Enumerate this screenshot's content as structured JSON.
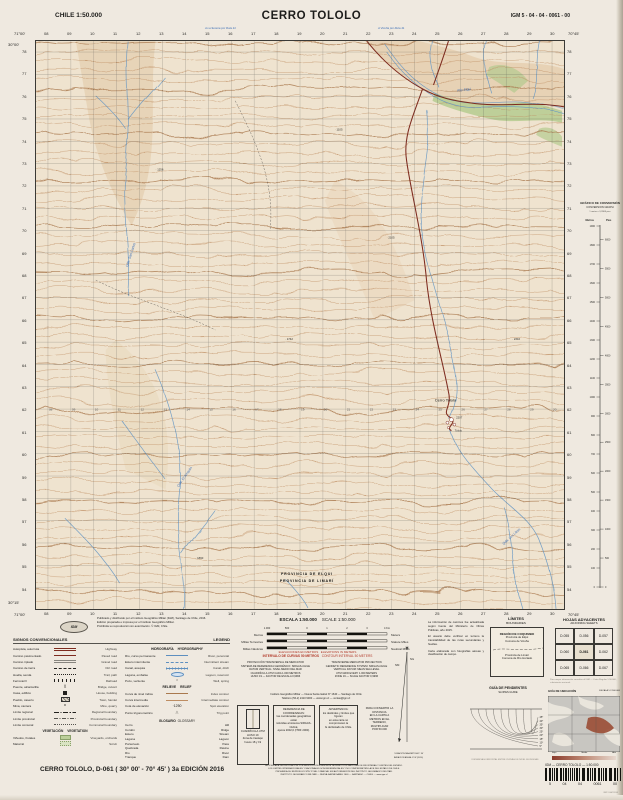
{
  "header": {
    "country_scale": "CHILE  1:50.000",
    "title": "CERRO TOLOLO",
    "sheet_code": "IGM 5 - 04 - 04 - 0061 - 00",
    "route_note_left": "A La Serena por Ruta 41",
    "route_note_right": "A Vicuña por Ruta 41"
  },
  "map": {
    "corners": {
      "tl_lon": "71°00'",
      "tr_lon": "70°45'",
      "bl_lon": "71°00'",
      "br_lon": "70°45'",
      "lat_top": "30°00'",
      "lat_bottom": "30°15'"
    },
    "top_labels": [
      "08",
      "09",
      "10",
      "11",
      "12",
      "13",
      "14",
      "15",
      "16",
      "17",
      "18",
      "19",
      "20",
      "21",
      "22",
      "23",
      "24",
      "25",
      "26",
      "27",
      "28",
      "29",
      "30"
    ],
    "left_labels": [
      "78",
      "77",
      "76",
      "75",
      "74",
      "73",
      "72",
      "71",
      "70",
      "69",
      "68",
      "67",
      "66",
      "65",
      "64",
      "63",
      "62",
      "61",
      "60",
      "59",
      "58",
      "57",
      "56",
      "55",
      "54"
    ],
    "place_labels": [
      {
        "t": "Cerro Tololo",
        "x": 411,
        "y": 362,
        "c": "place"
      },
      {
        "t": "Tololo",
        "x": 424,
        "y": 392,
        "c": "small"
      },
      {
        "t": "PROVINCIA DE ELQUI",
        "x": 272,
        "y": 536,
        "c": "prov"
      },
      {
        "t": "PROVINCIA DE LIMARÍ",
        "x": 272,
        "y": 543,
        "c": "prov"
      },
      {
        "t": "Río Elqui",
        "x": 430,
        "y": 50,
        "c": "water",
        "r": -6
      },
      {
        "t": "Qda. San Carlos",
        "x": 96,
        "y": 215,
        "c": "water",
        "r": -72
      },
      {
        "t": "Qda. El Arrayán",
        "x": 150,
        "y": 438,
        "c": "water",
        "r": -55
      },
      {
        "t": "Qda. Los Litres",
        "x": 478,
        "y": 498,
        "c": "water",
        "r": -42
      }
    ],
    "spot_heights": [
      {
        "v": "2207",
        "x": 420,
        "y": 379
      },
      {
        "v": "1256",
        "x": 120,
        "y": 130
      },
      {
        "v": "1742",
        "x": 250,
        "y": 300
      },
      {
        "v": "2105",
        "x": 352,
        "y": 198
      },
      {
        "v": "1890",
        "x": 160,
        "y": 520
      },
      {
        "v": "2310",
        "x": 478,
        "y": 300
      },
      {
        "v": "1105",
        "x": 300,
        "y": 90
      }
    ]
  },
  "scalebar": {
    "title_es": "ESCALA 1:50.000",
    "title_en": "SCALE 1:50.000",
    "ticks": [
      "1.000",
      "500",
      "0",
      "1",
      "2",
      "3",
      "4 Km"
    ],
    "rows": [
      {
        "es": "Metros",
        "en": "Meters"
      },
      {
        "es": "Millas Terrestres",
        "en": "Statute Miles"
      },
      {
        "es": "Millas Náuticas",
        "en": "Nautical Miles"
      }
    ],
    "elev_es": "ELEVACIONES EN METROS",
    "elev_en": "ELEVATIONS IN METERS",
    "interval_es": "INTERVALO DE CURVAS 50 METROS",
    "interval_en": "CONTOUR INTERVAL 50 METERS"
  },
  "tech": {
    "es": [
      "PROYECCIÓN TRANSVERSAL DE MERCATOR",
      "SISTEMA DE REFERENCIA GEODÉSICO: SIRGAS-CHILE",
      "DATUM VERTICAL: NIVEL MEDIO DEL MAR",
      "CUADRÍCULA UTM CADA 1.000 METROS",
      "HUSO 19 — FACTOR DE ESCALA 0,9996"
    ],
    "en": [
      "TRANSVERSE MERCATOR PROJECTION",
      "GEODETIC REFERENCE SYSTEM: SIRGAS-CHILE",
      "VERTICAL DATUM: MEAN SEA LEVEL",
      "UTM GRID EVERY 1.000 METERS",
      "ZONE 19 — SCALE FACTOR 0,9996"
    ],
    "address": [
      "Instituto Geográfico Militar — Nueva Santa Isabel N° 1640 — Santiago de Chile",
      "Teléfono (56-2) 2410 9300 — www.igm.cl — ventas@igm.cl"
    ]
  },
  "notes_boxes": [
    {
      "lines": [
        "CUADRÍCULA UTM",
        "HUSO 19",
        "Zona de traslapo",
        "husos 18 y 19"
      ]
    },
    {
      "lines": [
        "REFERENCIA DE COORDENADAS:",
        "las coordenadas geográficas están",
        "referidas al sistema SIRGAS-CHILE,",
        "época 2002,0 (ITRF 2000)."
      ]
    },
    {
      "lines": [
        "ADVERTENCIA:",
        "los deslindes y límites que figuran",
        "en esta carta no comprometen la",
        "fe del Estado de Chile."
      ]
    },
    {
      "lines": [
        "PARA CONVERTIR LA DISTANCIA",
        "EN LA CARTA A METROS EN EL",
        "TERRENO, MULTIPLICAR",
        "POR 50.000"
      ]
    }
  ],
  "declination": {
    "label_ng": "NG",
    "label_nm": "NM",
    "note1": "DECLINACIÓN MAGNÉTICA 2° 30' E",
    "note2": "VARIACIÓN ANUAL 8' W (2016)"
  },
  "side_notes": [
    "La información de caminos fue actualizada según fuente del Ministerio de Obras Públicas, año 2015.",
    "El usuario debe verificar en terreno la transitabilidad de las rutas secundarias y huellas.",
    "Carta elaborada con fotografías aéreas y clasificación de campo."
  ],
  "limits_box": {
    "title": "LÍMITES",
    "subtitle": "BOUNDARIES",
    "region": "REGIÓN DE COQUIMBO",
    "top_lines": [
      "Provincia de Elqui",
      "Comuna de Vicuña"
    ],
    "bottom_lines": [
      "Provincia de Limarí",
      "Comuna de Río Hurtado"
    ]
  },
  "adjoining": {
    "title": "HOJAS ADYACENTES",
    "subtitle": "ADJOINING SHEETS",
    "cells": [
      "D-055",
      "D-056",
      "D-057",
      "D-060",
      "D-061",
      "D-062",
      "D-065",
      "D-066",
      "D-067"
    ],
    "note": "Para mayor información consultar al IGM — Carta Regular 1:50.000, cubrimiento nacional."
  },
  "location_guide": {
    "title": "GUÍA DE UBICACIÓN",
    "scale": "ESCALA 1:2.500.000"
  },
  "gradient_strip": {
    "labels": [
      "Baja",
      "Media",
      "Alta"
    ]
  },
  "slopes_guide": {
    "title": "GUÍA DE PENDIENTES",
    "subtitle": "SLOPES GUIDE",
    "degrees": [
      "5°",
      "10°",
      "15°",
      "20°",
      "25°",
      "30°",
      "35°",
      "40°",
      "45°"
    ],
    "caption": "DISTANCIA HORIZONTAL ENTRE CURVAS DE NIVEL SUCESIVAS"
  },
  "legend": {
    "title": "SIGNOS CONVENCIONALES",
    "title_en": "LEGEND",
    "col1": [
      {
        "t": "i",
        "es": "Autopista, autorruta",
        "en": "Highway",
        "sym": "road2"
      },
      {
        "t": "i",
        "es": "Camino pavimentado",
        "en": "Paved road",
        "sym": "road"
      },
      {
        "t": "i",
        "es": "Camino ripiado",
        "en": "Gravel road",
        "sym": "roadg"
      },
      {
        "t": "i",
        "es": "Camino de tierra",
        "en": "Dirt road",
        "sym": "dash"
      },
      {
        "t": "i",
        "es": "Huella, senda",
        "en": "Trail, path",
        "sym": "dots"
      },
      {
        "t": "i",
        "es": "Ferrocarril",
        "en": "Railroad",
        "sym": "rail"
      },
      {
        "t": "i",
        "es": "Puente, alcantarilla",
        "en": "Bridge, culvert",
        "sym": "glyph:)("
      },
      {
        "t": "i",
        "es": "Casa, edificio",
        "en": "House, building",
        "sym": "bldg"
      },
      {
        "t": "i",
        "es": "Pueblo, caserío",
        "en": "Town, hamlet",
        "sym": "town"
      },
      {
        "t": "i",
        "es": "Mina, cantera",
        "en": "Mine, quarry",
        "sym": "glyph:⨯"
      },
      {
        "t": "i",
        "es": "Límite regional",
        "en": "Regional boundary",
        "sym": "blim"
      },
      {
        "t": "i",
        "es": "Límite provincial",
        "en": "Provincial boundary",
        "sym": "blim2"
      },
      {
        "t": "i",
        "es": "Límite comunal",
        "en": "Communal boundary",
        "sym": "blim3"
      },
      {
        "t": "h",
        "es": "VEGETACIÓN",
        "en": "VEGETATION"
      },
      {
        "t": "i",
        "es": "Viñedos, frutales",
        "en": "Vineyards, orchards",
        "sym": "veg"
      },
      {
        "t": "i",
        "es": "Matorral",
        "en": "Scrub",
        "sym": "veg2"
      }
    ],
    "col2": [
      {
        "t": "h",
        "es": "HIDROGRAFÍA",
        "en": "HYDROGRAPHY"
      },
      {
        "t": "i",
        "es": "Río, curso permanente",
        "en": "River, perennial",
        "sym": "river"
      },
      {
        "t": "i",
        "es": "Estero intermitente",
        "en": "Intermittent stream",
        "sym": "riverd"
      },
      {
        "t": "i",
        "es": "Canal, acequia",
        "en": "Canal, ditch",
        "sym": "canal"
      },
      {
        "t": "i",
        "es": "Laguna, embalse",
        "en": "Lagoon, reservoir",
        "sym": "lake"
      },
      {
        "t": "i",
        "es": "Pozo, vertiente",
        "en": "Well, spring",
        "sym": "glyph:○"
      },
      {
        "t": "h",
        "es": "RELIEVE",
        "en": "RELIEF"
      },
      {
        "t": "i",
        "es": "Curva de nivel índice",
        "en": "Index contour",
        "sym": "cont"
      },
      {
        "t": "i",
        "es": "Curva intermedia",
        "en": "Intermediate contour",
        "sym": "cont2"
      },
      {
        "t": "i",
        "es": "Cota de elevación",
        "en": "Spot elevation",
        "sym": "glyph:·1250"
      },
      {
        "t": "i",
        "es": "Punto trigonométrico",
        "en": "Trig point",
        "sym": "glyph:△"
      }
    ]
  },
  "glossary": {
    "title": "GLOSARIO",
    "title_en": "GLOSSARY",
    "pairs": [
      [
        "Cerro",
        "Hill"
      ],
      [
        "Cordón",
        "Ridge"
      ],
      [
        "Estero",
        "Stream"
      ],
      [
        "Laguna",
        "Lagoon"
      ],
      [
        "Portezuelo",
        "Pass"
      ],
      [
        "Quebrada",
        "Ravine"
      ],
      [
        "Río",
        "River"
      ],
      [
        "Tranque",
        "Dam"
      ]
    ]
  },
  "publisher": {
    "logo": "IGM",
    "lines": [
      "Publicado y distribuido por el Instituto Geográfico Militar (IGM), Santiago de Chile, 2016.",
      "Edición preparada e impresa por el Instituto Geográfico Militar.",
      "Prohibida su reproducción sin autorización. © IGM, Chile."
    ]
  },
  "conversion": {
    "title": "GRÁFICO DE CONVERSIÓN",
    "subtitle": "CONVERSION GRAPH",
    "col_m": "Metros",
    "col_ft": "Pies",
    "note": "1 metro = 3,2808 pies",
    "meters_max": 1900,
    "meters_step": 100,
    "feet_step": 500
  },
  "footer": {
    "left": "CERRO TOLOLO, D-061 ( 30° 00' - 70° 45' ) 3a EDICIÓN 2016",
    "center_lines": [
      "AUTORIZADA LA CIRCULACIÓN POR RESOLUCIÓN EXENTA DE LA DIRECCIÓN NACIONAL DE FRONTERAS Y LÍMITES DEL ESTADO.",
      "LOS LÍMITES INTERNACIONALES Y NACIONALES SON REFERENCIALES Y NO COMPROMETEN LA FE DEL ESTADO DE CHILE.",
      "PROHIBIDA SU REPRODUCCIÓN TOTAL O PARCIAL SIN AUTORIZACIÓN DEL INSTITUTO GEOGRÁFICO MILITAR.",
      "INSTITUTO GEOGRÁFICO MILITAR — NUEVA SANTA ISABEL 1640 — SANTIAGO — CHILE — www.igm.cl"
    ],
    "right_label": "IGM — CERRO TOLOLO — 1:50.000",
    "barcode_digits": [
      "5",
      "04",
      "04",
      "0061",
      "00"
    ],
    "imprint": "IMP. IGM 2016"
  }
}
